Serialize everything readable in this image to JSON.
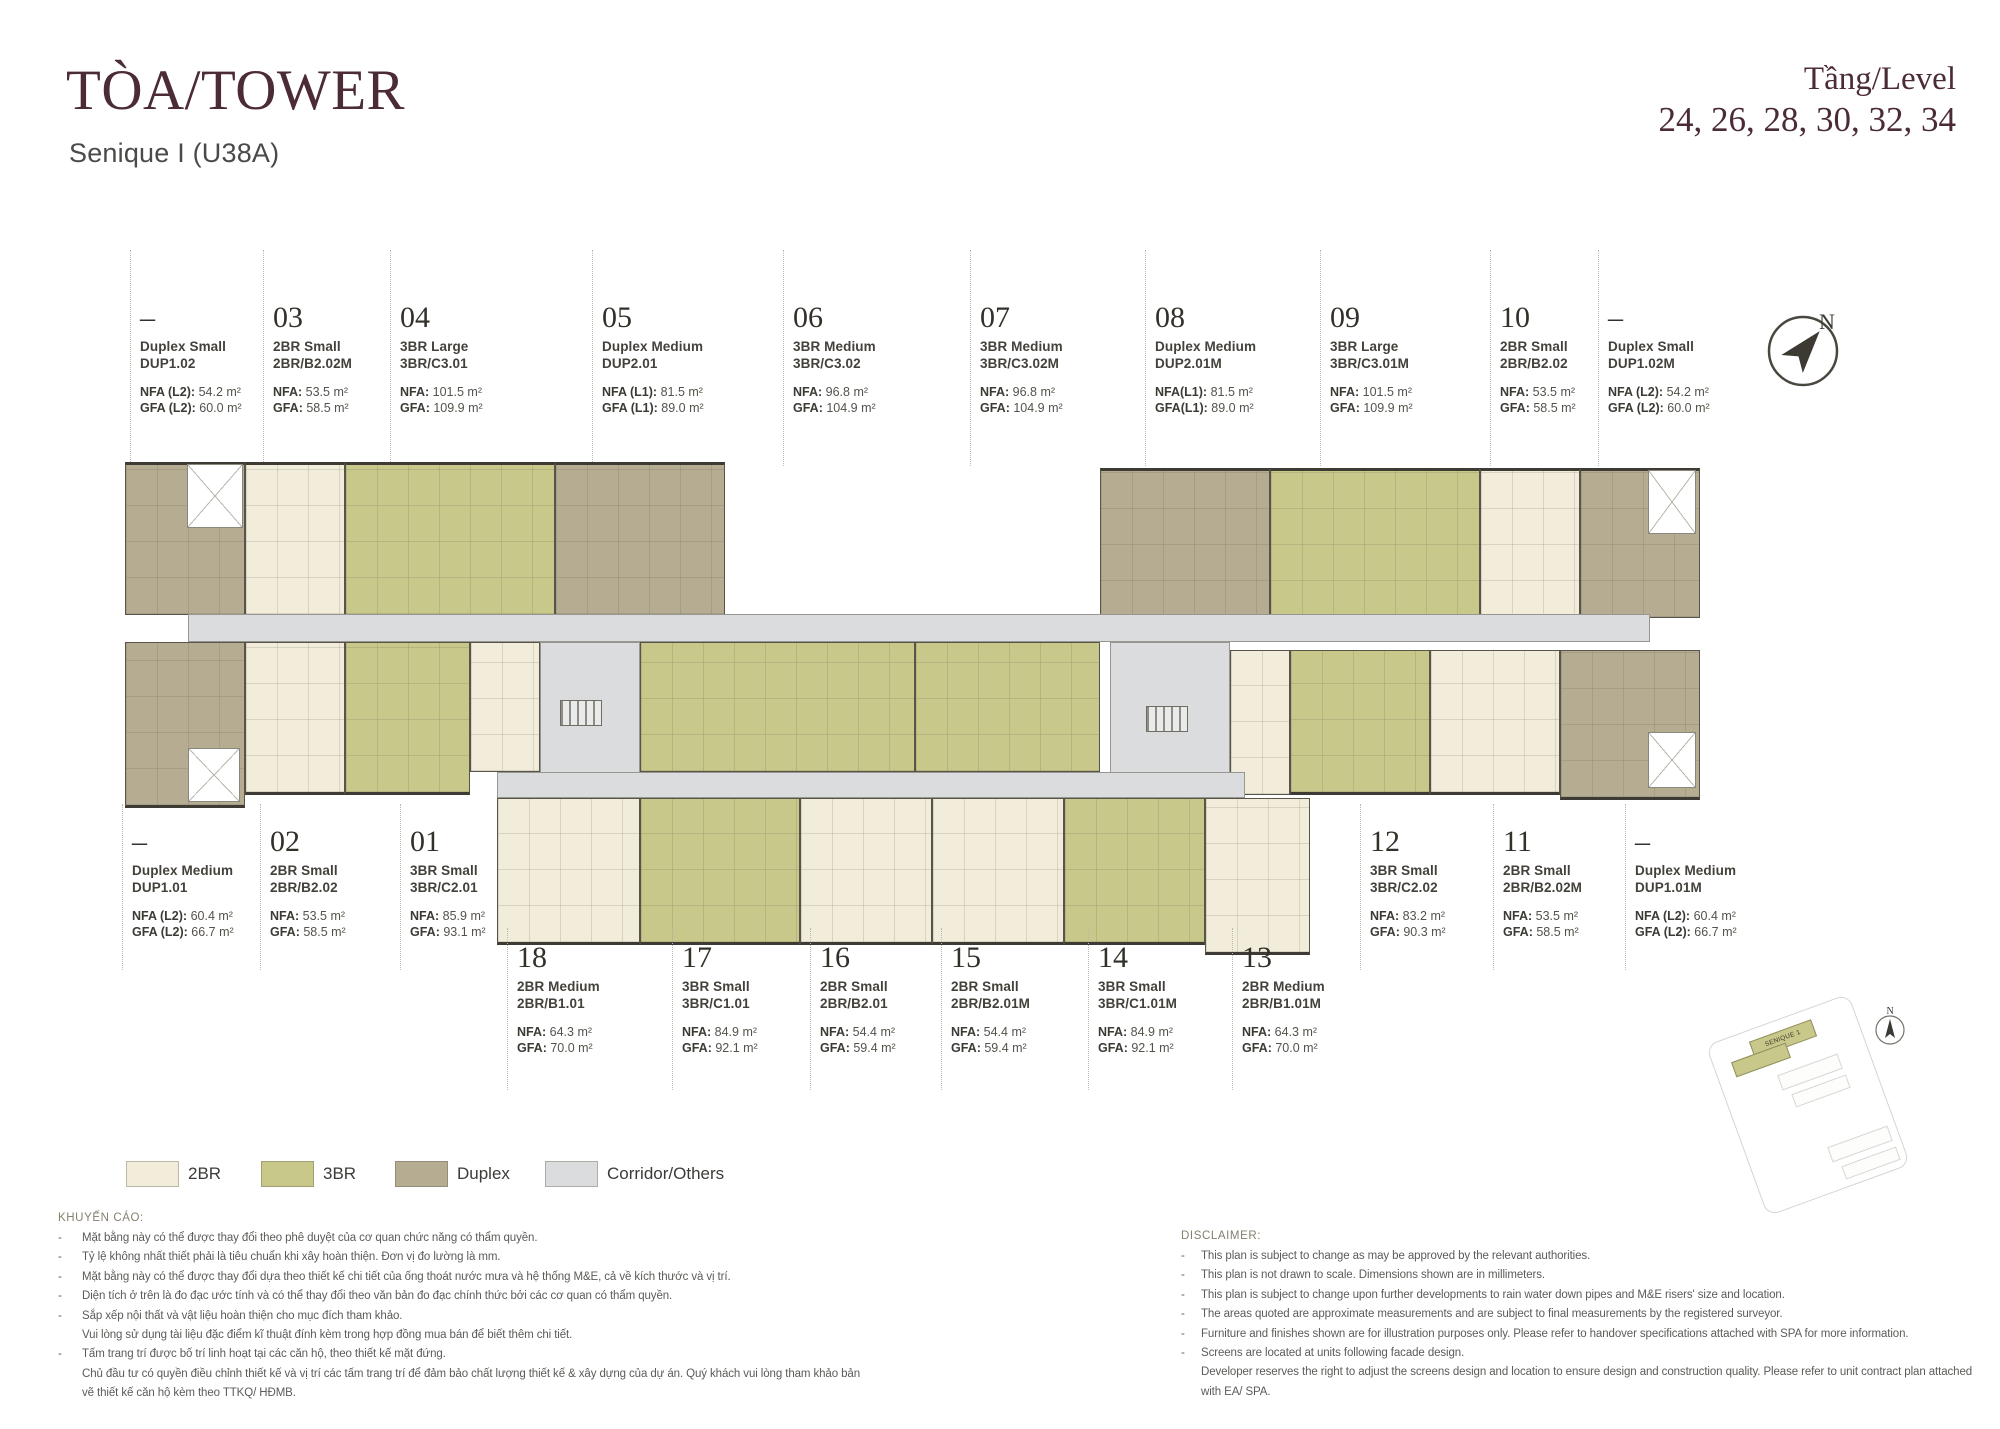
{
  "colors": {
    "2br": "#f2edda",
    "3br": "#c8c88a",
    "duplex": "#b6ac92",
    "corridor": "#dadcdd",
    "accent": "#4b2b37"
  },
  "header": {
    "title": "TÒA/TOWER",
    "subtitle": "Senique I (U38A)",
    "level_label": "Tầng/Level",
    "levels": "24, 26, 28, 30, 32, 34"
  },
  "compass": {
    "n": "N"
  },
  "sitemap": {
    "building_label": "SENIQUE 1",
    "n": "N"
  },
  "units_top": [
    {
      "no": "–",
      "name": "Duplex Small",
      "code": "DUP1.02",
      "nfa_label": "NFA (L2):",
      "nfa_value": "54.2 m²",
      "gfa_label": "GFA (L2):",
      "gfa_value": "60.0 m²"
    },
    {
      "no": "03",
      "name": "2BR Small",
      "code": "2BR/B2.02M",
      "nfa_label": "NFA:",
      "nfa_value": "53.5 m²",
      "gfa_label": "GFA:",
      "gfa_value": "58.5 m²"
    },
    {
      "no": "04",
      "name": "3BR Large",
      "code": "3BR/C3.01",
      "nfa_label": "NFA:",
      "nfa_value": "101.5 m²",
      "gfa_label": "GFA:",
      "gfa_value": "109.9 m²"
    },
    {
      "no": "05",
      "name": "Duplex Medium",
      "code": "DUP2.01",
      "nfa_label": "NFA (L1):",
      "nfa_value": "81.5 m²",
      "gfa_label": "GFA (L1):",
      "gfa_value": "89.0 m²"
    },
    {
      "no": "06",
      "name": "3BR Medium",
      "code": "3BR/C3.02",
      "nfa_label": "NFA:",
      "nfa_value": "96.8 m²",
      "gfa_label": "GFA:",
      "gfa_value": "104.9 m²"
    },
    {
      "no": "07",
      "name": "3BR Medium",
      "code": "3BR/C3.02M",
      "nfa_label": "NFA:",
      "nfa_value": "96.8 m²",
      "gfa_label": "GFA:",
      "gfa_value": "104.9 m²"
    },
    {
      "no": "08",
      "name": "Duplex Medium",
      "code": "DUP2.01M",
      "nfa_label": "NFA(L1):",
      "nfa_value": "81.5 m²",
      "gfa_label": "GFA(L1):",
      "gfa_value": "89.0 m²"
    },
    {
      "no": "09",
      "name": "3BR Large",
      "code": "3BR/C3.01M",
      "nfa_label": "NFA:",
      "nfa_value": "101.5 m²",
      "gfa_label": "GFA:",
      "gfa_value": "109.9 m²"
    },
    {
      "no": "10",
      "name": "2BR Small",
      "code": "2BR/B2.02",
      "nfa_label": "NFA:",
      "nfa_value": "53.5 m²",
      "gfa_label": "GFA:",
      "gfa_value": "58.5 m²"
    },
    {
      "no": "–",
      "name": "Duplex Small",
      "code": "DUP1.02M",
      "nfa_label": "NFA (L2):",
      "nfa_value": "54.2 m²",
      "gfa_label": "GFA (L2):",
      "gfa_value": "60.0 m²"
    }
  ],
  "units_bottom_left": [
    {
      "no": "–",
      "name": "Duplex Medium",
      "code": "DUP1.01",
      "nfa_label": "NFA (L2):",
      "nfa_value": "60.4 m²",
      "gfa_label": "GFA (L2):",
      "gfa_value": "66.7 m²"
    },
    {
      "no": "02",
      "name": "2BR Small",
      "code": "2BR/B2.02",
      "nfa_label": "NFA:",
      "nfa_value": "53.5 m²",
      "gfa_label": "GFA:",
      "gfa_value": "58.5 m²"
    },
    {
      "no": "01",
      "name": "3BR Small",
      "code": "3BR/C2.01",
      "nfa_label": "NFA:",
      "nfa_value": "85.9 m²",
      "gfa_label": "GFA:",
      "gfa_value": "93.1 m²"
    }
  ],
  "units_bottom_right": [
    {
      "no": "12",
      "name": "3BR Small",
      "code": "3BR/C2.02",
      "nfa_label": "NFA:",
      "nfa_value": "83.2 m²",
      "gfa_label": "GFA:",
      "gfa_value": "90.3 m²"
    },
    {
      "no": "11",
      "name": "2BR Small",
      "code": "2BR/B2.02M",
      "nfa_label": "NFA:",
      "nfa_value": "53.5 m²",
      "gfa_label": "GFA:",
      "gfa_value": "58.5 m²"
    },
    {
      "no": "–",
      "name": "Duplex Medium",
      "code": "DUP1.01M",
      "nfa_label": "NFA (L2):",
      "nfa_value": "60.4 m²",
      "gfa_label": "GFA (L2):",
      "gfa_value": "66.7 m²"
    }
  ],
  "units_bottom_center": [
    {
      "no": "18",
      "name": "2BR Medium",
      "code": "2BR/B1.01",
      "nfa_label": "NFA:",
      "nfa_value": "64.3 m²",
      "gfa_label": "GFA:",
      "gfa_value": "70.0 m²"
    },
    {
      "no": "17",
      "name": "3BR Small",
      "code": "3BR/C1.01",
      "nfa_label": "NFA:",
      "nfa_value": "84.9 m²",
      "gfa_label": "GFA:",
      "gfa_value": "92.1 m²"
    },
    {
      "no": "16",
      "name": "2BR Small",
      "code": "2BR/B2.01",
      "nfa_label": "NFA:",
      "nfa_value": "54.4 m²",
      "gfa_label": "GFA:",
      "gfa_value": "59.4 m²"
    },
    {
      "no": "15",
      "name": "2BR Small",
      "code": "2BR/B2.01M",
      "nfa_label": "NFA:",
      "nfa_value": "54.4 m²",
      "gfa_label": "GFA:",
      "gfa_value": "59.4 m²"
    },
    {
      "no": "14",
      "name": "3BR Small",
      "code": "3BR/C1.01M",
      "nfa_label": "NFA:",
      "nfa_value": "84.9 m²",
      "gfa_label": "GFA:",
      "gfa_value": "92.1 m²"
    },
    {
      "no": "13",
      "name": "2BR Medium",
      "code": "2BR/B1.01M",
      "nfa_label": "NFA:",
      "nfa_value": "64.3 m²",
      "gfa_label": "GFA:",
      "gfa_value": "70.0 m²"
    }
  ],
  "legend": [
    {
      "label": "2BR",
      "color": "#f2edda"
    },
    {
      "label": "3BR",
      "color": "#c8c88a"
    },
    {
      "label": "Duplex",
      "color": "#b6ac92"
    },
    {
      "label": "Corridor/Others",
      "color": "#dadcdd"
    }
  ],
  "advisory": {
    "heading": "KHUYẾN CÁO:",
    "lines": [
      {
        "d": "-",
        "t": "Mặt bằng này có thể được thay đổi theo phê duyệt của cơ quan chức năng có thẩm quyền."
      },
      {
        "d": "-",
        "t": "Tỷ lệ không nhất thiết phải là tiêu chuẩn khi xây hoàn thiện. Đơn vị đo lường là mm."
      },
      {
        "d": "-",
        "t": "Mặt bằng này có thể được thay đổi dựa theo thiết kế chi tiết của ống thoát nước mưa và hệ thống M&E, cả về kích thước và vị trí."
      },
      {
        "d": "-",
        "t": "Diện tích ở trên là đo đạc ước tính và có thể thay đổi theo văn bản đo đạc chính thức bởi các cơ quan có thẩm quyền."
      },
      {
        "d": "-",
        "t": "Sắp xếp nội thất và vật liệu hoàn thiện cho mục đích tham khảo."
      },
      {
        "d": "",
        "t": "Vui lòng sử dụng tài liệu đặc điểm kĩ thuật đính kèm trong hợp đồng mua bán để biết thêm chi tiết."
      },
      {
        "d": "-",
        "t": "Tấm trang trí được bố trí linh hoạt tại các căn hộ, theo thiết kế mặt đứng."
      },
      {
        "d": "",
        "t": "Chủ đầu tư có quyền điều chỉnh thiết kế và vị trí các tấm trang trí để đảm bảo chất lượng thiết kế & xây dựng của dự án. Quý khách vui lòng tham khảo bản"
      },
      {
        "d": "",
        "t": "vẽ thiết kế căn hộ kèm theo TTKQ/ HĐMB."
      }
    ]
  },
  "disclaimer": {
    "heading": "DISCLAIMER:",
    "lines": [
      {
        "d": "-",
        "t": "This plan is subject to change as may be approved by the relevant authorities."
      },
      {
        "d": "-",
        "t": "This plan is not drawn to scale. Dimensions shown are in millimeters."
      },
      {
        "d": "-",
        "t": "This plan is subject to change upon further developments to rain water down pipes and M&E risers' size and location."
      },
      {
        "d": "-",
        "t": "The areas quoted are approximate measurements and are subject to final measurements by the registered surveyor."
      },
      {
        "d": "-",
        "t": "Furniture and finishes shown are for illustration purposes only. Please refer to handover specifications attached with SPA for more information."
      },
      {
        "d": "-",
        "t": "Screens are located at units following facade design."
      },
      {
        "d": "",
        "t": "Developer reserves the right to adjust the screens design and location to ensure design and construction quality. Please refer to unit contract plan attached"
      },
      {
        "d": "",
        "t": "with EA/ SPA."
      }
    ]
  }
}
